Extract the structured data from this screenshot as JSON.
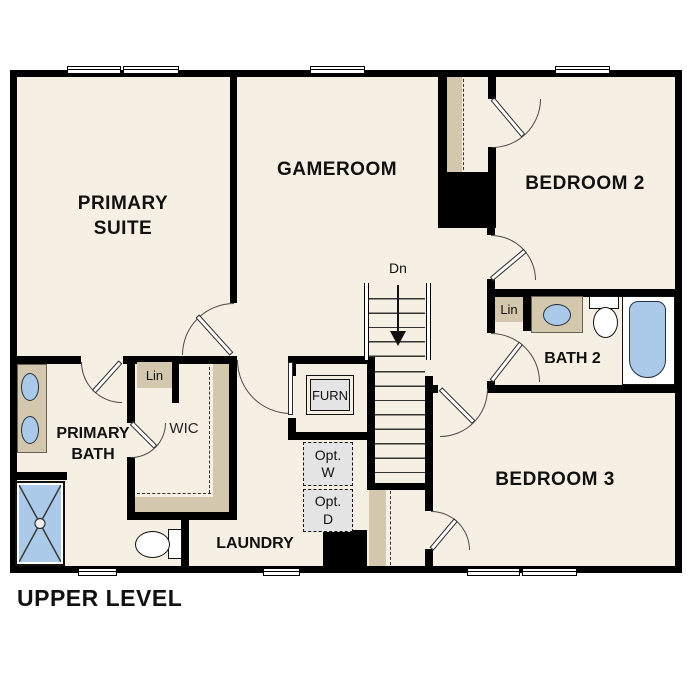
{
  "title": "UPPER LEVEL",
  "rooms": {
    "primary_suite": "PRIMARY\nSUITE",
    "gameroom": "GAMEROOM",
    "bedroom_2": "BEDROOM 2",
    "bedroom_3": "BEDROOM 3",
    "bath_2": "BATH 2",
    "primary_bath": "PRIMARY\nBATH",
    "laundry": "LAUNDRY",
    "wic": "WIC"
  },
  "features": {
    "furnace": "FURN",
    "linen_wic": "Lin",
    "linen_bath2": "Lin",
    "optional_washer": "Opt.\nW",
    "optional_dryer": "Opt.\nD",
    "stairs_direction": "Dn"
  },
  "colors": {
    "floor": "#f6efe3",
    "casework_tan": "#d3c7ae",
    "fixture_blue": "#abc9e8",
    "appliance_gray": "#e4e4e4",
    "wall": "#000000"
  }
}
